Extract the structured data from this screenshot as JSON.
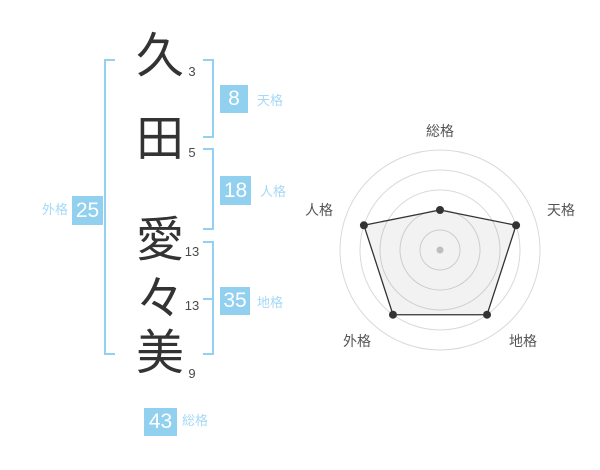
{
  "name": {
    "full": "久田 愛々美",
    "characters": [
      {
        "char": "久",
        "strokes": "3"
      },
      {
        "char": "田",
        "strokes": "5"
      },
      {
        "char": "愛",
        "strokes": "13"
      },
      {
        "char": "々",
        "strokes": "13"
      },
      {
        "char": "美",
        "strokes": "9"
      }
    ]
  },
  "kaku": {
    "tenkaku": {
      "label": "天格",
      "value": "8"
    },
    "jinkaku": {
      "label": "人格",
      "value": "18"
    },
    "chikaku": {
      "label": "地格",
      "value": "35"
    },
    "gaikaku": {
      "label": "外格",
      "value": "25"
    },
    "soukaku": {
      "label": "総格",
      "value": "43"
    }
  },
  "colors": {
    "accent_blue": "#92d0f0",
    "label_blue": "#a6d9f5",
    "badge_text": "#ffffff",
    "kanji_text": "#333333"
  },
  "chart_data": {
    "type": "radar",
    "categories": [
      "総格",
      "天格",
      "地格",
      "外格",
      "人格"
    ],
    "values": [
      40,
      80,
      80,
      80,
      80
    ],
    "max": 100,
    "rings": [
      20,
      40,
      60,
      80,
      100
    ],
    "grid": "circular",
    "legend": "none",
    "line_color": "#333333",
    "point_color": "#333333",
    "grid_color": "#d9d9d9",
    "fill_color": "rgba(0,0,0,0.05)",
    "center_dot_color": "#c9c9c9",
    "label_color": "#555555"
  }
}
